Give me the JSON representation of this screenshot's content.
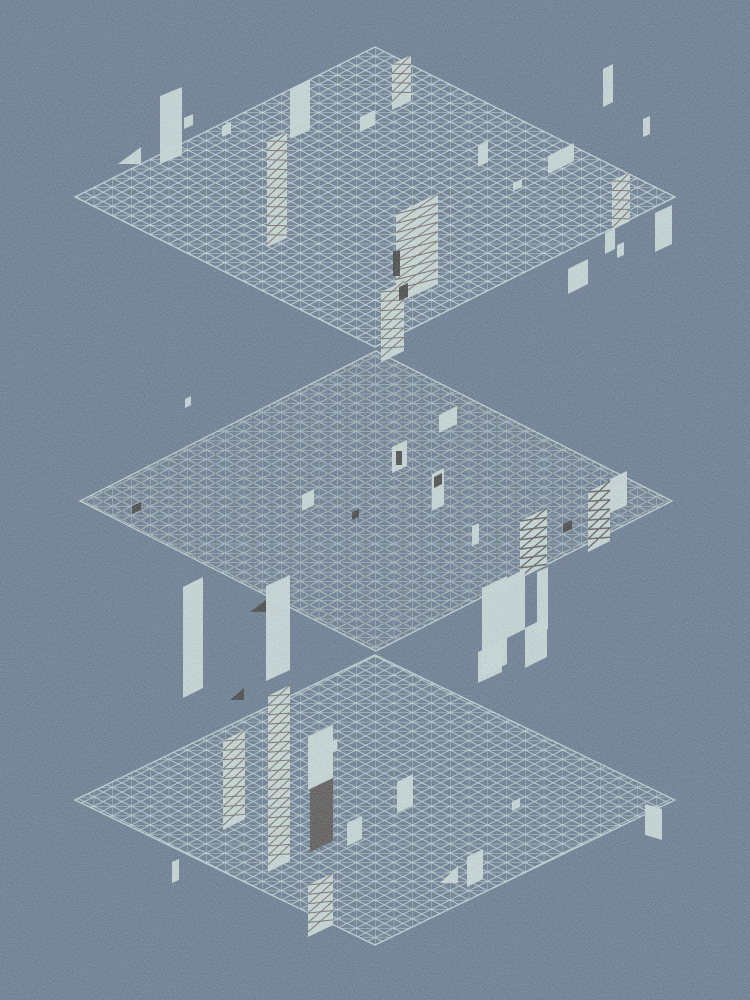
{
  "scene": {
    "width": 750,
    "height": 1000,
    "colors": {
      "background": "#67798d",
      "grid_line": "#cddfdb",
      "dark_node": "#70665b",
      "pale": "#cfdfda",
      "ink": "#3e3a35",
      "umber": "#57504a",
      "brace": "#5d4c3e",
      "brace_dark": "#433b33"
    },
    "cell": {
      "w": 18.75,
      "h": 9.375
    },
    "noise": {
      "base_frequency": 0.9,
      "light_opacity": 0.5,
      "dark_opacity": 0.42
    },
    "grids": [
      {
        "name": "top",
        "cx": 375,
        "cy": 197,
        "rx": 300,
        "ry": 150,
        "opacity": 1.0,
        "dark_overlay": false
      },
      {
        "name": "middle",
        "cx": 376,
        "cy": 501,
        "rx": 296,
        "ry": 150,
        "opacity": 0.9,
        "dark_overlay": true
      },
      {
        "name": "bottom",
        "cx": 375,
        "cy": 800,
        "rx": 300,
        "ry": 145,
        "opacity": 0.92,
        "dark_overlay": false
      }
    ],
    "walls": [
      {
        "x": 160,
        "y": 96,
        "w": 22,
        "dy": -9,
        "h": 68,
        "c": "pale"
      },
      {
        "x": 184,
        "y": 118,
        "w": 9,
        "dy": -4,
        "h": 11,
        "c": "pale"
      },
      {
        "type": "tri",
        "x": 118,
        "y": 147,
        "w": 23,
        "dy": 0,
        "h": 17,
        "c": "pale"
      },
      {
        "x": 222,
        "y": 126,
        "w": 9,
        "dy": -4,
        "h": 11,
        "c": "pale"
      },
      {
        "x": 267,
        "y": 141,
        "w": 20,
        "dy": -9,
        "h": 106,
        "c": "pale",
        "brace": true
      },
      {
        "x": 290,
        "y": 89,
        "w": 20,
        "dy": -9,
        "h": 50,
        "c": "pale"
      },
      {
        "x": 360,
        "y": 117,
        "w": 15,
        "dy": -7,
        "h": 15,
        "c": "pale"
      },
      {
        "x": 392,
        "y": 64,
        "w": 19,
        "dy": -9,
        "h": 46,
        "c": "pale",
        "brace": true
      },
      {
        "x": 478,
        "y": 146,
        "w": 10,
        "dy": -5,
        "h": 21,
        "c": "pale"
      },
      {
        "x": 548,
        "y": 156,
        "w": 26,
        "dy": -13,
        "h": 18,
        "c": "pale"
      },
      {
        "x": 513,
        "y": 183,
        "w": 9,
        "dy": -4,
        "h": 8,
        "c": "pale"
      },
      {
        "x": 612,
        "y": 181,
        "w": 18,
        "dy": -9,
        "h": 49,
        "c": "pale",
        "brace": true
      },
      {
        "x": 655,
        "y": 213,
        "w": 17,
        "dy": -8,
        "h": 39,
        "c": "pale"
      },
      {
        "x": 603,
        "y": 69,
        "w": 10,
        "dy": -5,
        "h": 38,
        "c": "pale"
      },
      {
        "x": 643,
        "y": 119,
        "w": 7,
        "dy": -3,
        "h": 18,
        "c": "pale"
      },
      {
        "x": 568,
        "y": 269,
        "w": 20,
        "dy": -10,
        "h": 25,
        "c": "pale"
      },
      {
        "x": 605,
        "y": 233,
        "w": 10,
        "dy": -5,
        "h": 21,
        "c": "pale"
      },
      {
        "x": 617,
        "y": 245,
        "w": 7,
        "dy": -3,
        "h": 13,
        "c": "pale"
      },
      {
        "x": 396,
        "y": 214,
        "w": 42,
        "dy": -20,
        "h": 90,
        "c": "pale",
        "brace": true
      },
      {
        "x": 393,
        "y": 251,
        "w": 7,
        "dy": 0,
        "h": 25,
        "c": "ink"
      },
      {
        "x": 381,
        "y": 292,
        "w": 23,
        "dy": -11,
        "h": 70,
        "c": "pale",
        "brace": true
      },
      {
        "x": 399,
        "y": 287,
        "w": 9,
        "dy": -4,
        "h": 14,
        "c": "ink"
      },
      {
        "x": 185,
        "y": 399,
        "w": 6,
        "dy": -3,
        "h": 9,
        "c": "pale"
      },
      {
        "x": 132,
        "y": 506,
        "w": 9,
        "dy": -4,
        "h": 8,
        "c": "ink"
      },
      {
        "x": 302,
        "y": 495,
        "w": 12,
        "dy": -6,
        "h": 16,
        "c": "pale"
      },
      {
        "x": 352,
        "y": 512,
        "w": 7,
        "dy": -3,
        "h": 8,
        "c": "ink"
      },
      {
        "x": 392,
        "y": 447,
        "w": 15,
        "dy": -7,
        "h": 26,
        "c": "pale"
      },
      {
        "x": 396,
        "y": 451,
        "w": 6,
        "dy": 0,
        "h": 14,
        "c": "ink"
      },
      {
        "x": 439,
        "y": 415,
        "w": 18,
        "dy": -9,
        "h": 18,
        "c": "pale"
      },
      {
        "x": 432,
        "y": 474,
        "w": 12,
        "dy": -6,
        "h": 37,
        "c": "pale"
      },
      {
        "x": 434,
        "y": 477,
        "w": 8,
        "dy": -4,
        "h": 11,
        "c": "ink"
      },
      {
        "x": 472,
        "y": 526,
        "w": 7,
        "dy": -3,
        "h": 20,
        "c": "pale"
      },
      {
        "x": 563,
        "y": 524,
        "w": 9,
        "dy": -4,
        "h": 9,
        "c": "ink"
      },
      {
        "x": 610,
        "y": 479,
        "w": 17,
        "dy": -8,
        "h": 34,
        "c": "pale"
      },
      {
        "x": 588,
        "y": 492,
        "w": 22,
        "dy": -11,
        "h": 60,
        "c": "pale",
        "brace": true,
        "bd": true
      },
      {
        "x": 520,
        "y": 521,
        "w": 27,
        "dy": -13,
        "h": 56,
        "c": "pale",
        "brace": true,
        "bd": true
      },
      {
        "x": 482,
        "y": 588,
        "w": 25,
        "dy": -12,
        "h": 88,
        "c": "pale"
      },
      {
        "x": 507,
        "y": 578,
        "w": 18,
        "dy": -9,
        "h": 60,
        "c": "pale"
      },
      {
        "x": 525,
        "y": 628,
        "w": 22,
        "dy": -11,
        "h": 40,
        "c": "pale"
      },
      {
        "x": 537,
        "y": 572,
        "w": 11,
        "dy": -5,
        "h": 62,
        "c": "pale"
      },
      {
        "type": "tri",
        "x": 250,
        "y": 600,
        "w": 16,
        "dy": 0,
        "h": 12,
        "c": "ink"
      },
      {
        "x": 183,
        "y": 587,
        "w": 20,
        "dy": -10,
        "h": 111,
        "c": "pale"
      },
      {
        "x": 266,
        "y": 586,
        "w": 24,
        "dy": -11,
        "h": 95,
        "c": "pale"
      },
      {
        "type": "tri",
        "x": 230,
        "y": 688,
        "w": 14,
        "dy": 0,
        "h": 12,
        "c": "ink"
      },
      {
        "x": 223,
        "y": 741,
        "w": 22,
        "dy": -11,
        "h": 89,
        "c": "pale",
        "brace": true
      },
      {
        "x": 268,
        "y": 696,
        "w": 22,
        "dy": -11,
        "h": 176,
        "c": "pale",
        "brace": true
      },
      {
        "x": 308,
        "y": 737,
        "w": 25,
        "dy": -12,
        "h": 53,
        "c": "pale"
      },
      {
        "x": 310,
        "y": 789,
        "w": 23,
        "dy": -11,
        "h": 63,
        "c": "umber"
      },
      {
        "x": 308,
        "y": 885,
        "w": 25,
        "dy": -12,
        "h": 52,
        "c": "pale",
        "brace": true
      },
      {
        "x": 172,
        "y": 862,
        "w": 7,
        "dy": -3,
        "h": 21,
        "c": "pale"
      },
      {
        "x": 330,
        "y": 742,
        "w": 7,
        "dy": -3,
        "h": 11,
        "c": "pale"
      },
      {
        "x": 347,
        "y": 823,
        "w": 15,
        "dy": -7,
        "h": 23,
        "c": "pale"
      },
      {
        "x": 397,
        "y": 782,
        "w": 16,
        "dy": -8,
        "h": 31,
        "c": "pale"
      },
      {
        "type": "tri",
        "x": 440,
        "y": 866,
        "w": 18,
        "dy": 0,
        "h": 17,
        "c": "pale"
      },
      {
        "x": 467,
        "y": 857,
        "w": 16,
        "dy": -8,
        "h": 30,
        "c": "pale"
      },
      {
        "x": 512,
        "y": 802,
        "w": 8,
        "dy": -4,
        "h": 9,
        "c": "pale"
      },
      {
        "x": 478,
        "y": 652,
        "w": 24,
        "dy": -11,
        "h": 31,
        "c": "pale"
      },
      {
        "x": 645,
        "y": 804,
        "w": 17,
        "dy": 5,
        "h": 31,
        "c": "pale"
      }
    ]
  }
}
